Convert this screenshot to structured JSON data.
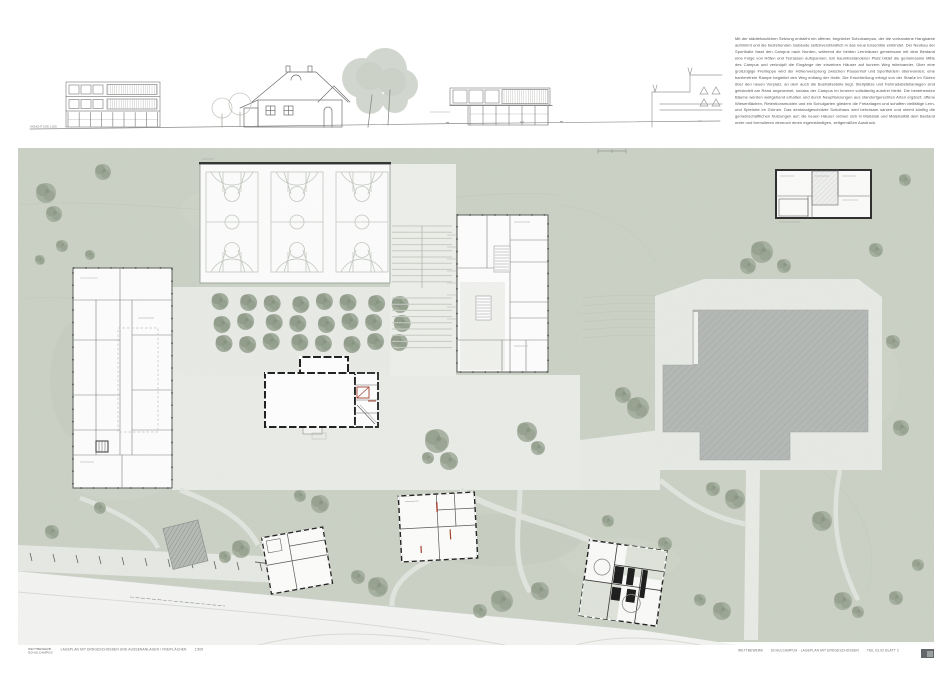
{
  "description": {
    "text": "Mit der städtebaulichen Setzung entsteht ein offener, begrünter Schulcampus, der die vorhandene Hangkante aufnimmt und die bestehenden Gebäude selbstverständlich in das neue Ensemble einbindet. Der Neubau der Sporthalle fasst den Campus nach Norden, während die beiden Lernhäuser gemeinsam mit dem Bestand eine Folge von Höfen und Terrassen aufspannen. Ein baumbestandener Platz bildet die gemeinsame Mitte des Campus und verknüpft die Eingänge der einzelnen Häuser auf kurzem Weg miteinander. Über eine großzügige Freitreppe wird der Höhenversprung zwischen Pausenhof und Sportfeldern überwunden; eine barrierefreie Rampe begleitet den Weg entlang der Halle. Die Erschließung erfolgt von der Straße im Süden über den neuen Vorplatz, an dem auch die Bushaltestelle liegt. Stellplätze und Fahrradabstellanlagen sind gebündelt am Rand angeordnet, sodass der Campus im Inneren vollständig autofrei bleibt. Die bestehenden Bäume werden weitgehend erhalten und durch Neupflanzungen aus standortgerechten Arten ergänzt; offene Wiesenflächen, Retentionsmulden und ein Schulgarten gliedern die Freianlagen und schaffen vielfältige Lern- und Spielorte im Grünen. Das denkmalgeschützte Schulhaus wird behutsam saniert und nimmt künftig die gemeinschaftlichen Nutzungen auf; die neuen Häuser ordnen sich in Maßstab und Materialität dem Bestand unter und formulieren dennoch einen eigenständigen, zeitgemäßen Ausdruck."
  },
  "elevation": {
    "label": "ANSICHT SÜD 1:200"
  },
  "titleblock": {
    "left_block_line1": "WETTBEWERB",
    "left_block_line2": "SCHULCAMPUS",
    "left_caption": "LAGEPLAN MIT ERDGESCHOSSEN UND AUSSENANLAGEN / FREIFLÄCHEN",
    "left_scale": "1:500",
    "right_project": "WETTBEWERB",
    "right_title": "SCHULCAMPUS · LAGEPLAN MIT ERDGESCHOSSEN",
    "right_sheet": "TEIL 03.02 BLATT 2"
  },
  "colors": {
    "field": "#cbd1c5",
    "paving": "#e9ebe7",
    "roof": "#b5b8b6",
    "accent_red": "#a23b2a",
    "court_line": "#c3c8c0",
    "tree": "#a2ac9b",
    "tree_dark": "#919c8a",
    "hall_edge": "#2f3230"
  },
  "site": {
    "courts": {
      "count": 3,
      "x": 206,
      "y": 172,
      "w": 52,
      "h": 100,
      "gap": 13
    },
    "grove": {
      "rows": 3,
      "cols": 8,
      "x": 222,
      "y": 303,
      "dx": 25.6,
      "dy": 20,
      "r": 8.5
    },
    "parking": {
      "ticks": 12
    },
    "stairs": {
      "groupA": {
        "x1": 392,
        "x2": 452,
        "y": 226,
        "step": 6.2,
        "count": 10
      },
      "groupB": {
        "x1": 392,
        "x2": 452,
        "y": 298,
        "step": 6.2,
        "count": 9
      }
    },
    "trees": [
      [
        46,
        193,
        10
      ],
      [
        54,
        214,
        8
      ],
      [
        103,
        172,
        8
      ],
      [
        62,
        246,
        6
      ],
      [
        40,
        260,
        5
      ],
      [
        90,
        255,
        5
      ],
      [
        762,
        252,
        11
      ],
      [
        748,
        266,
        8
      ],
      [
        784,
        266,
        7
      ],
      [
        876,
        250,
        7
      ],
      [
        905,
        180,
        6
      ],
      [
        893,
        342,
        7
      ],
      [
        901,
        428,
        8
      ],
      [
        638,
        408,
        11
      ],
      [
        623,
        395,
        8
      ],
      [
        527,
        432,
        10
      ],
      [
        538,
        448,
        7
      ],
      [
        437,
        441,
        12
      ],
      [
        449,
        461,
        9
      ],
      [
        428,
        458,
        6
      ],
      [
        320,
        504,
        9
      ],
      [
        300,
        496,
        6
      ],
      [
        241,
        549,
        9
      ],
      [
        225,
        557,
        6
      ],
      [
        100,
        508,
        6
      ],
      [
        52,
        532,
        7
      ],
      [
        378,
        587,
        10
      ],
      [
        358,
        577,
        7
      ],
      [
        502,
        601,
        11
      ],
      [
        540,
        591,
        9
      ],
      [
        480,
        611,
        7
      ],
      [
        735,
        499,
        10
      ],
      [
        713,
        489,
        7
      ],
      [
        665,
        544,
        7
      ],
      [
        608,
        521,
        6
      ],
      [
        822,
        521,
        10
      ],
      [
        843,
        601,
        9
      ],
      [
        858,
        612,
        6
      ],
      [
        722,
        611,
        9
      ],
      [
        700,
        600,
        6
      ],
      [
        896,
        598,
        7
      ],
      [
        918,
        565,
        6
      ]
    ]
  }
}
